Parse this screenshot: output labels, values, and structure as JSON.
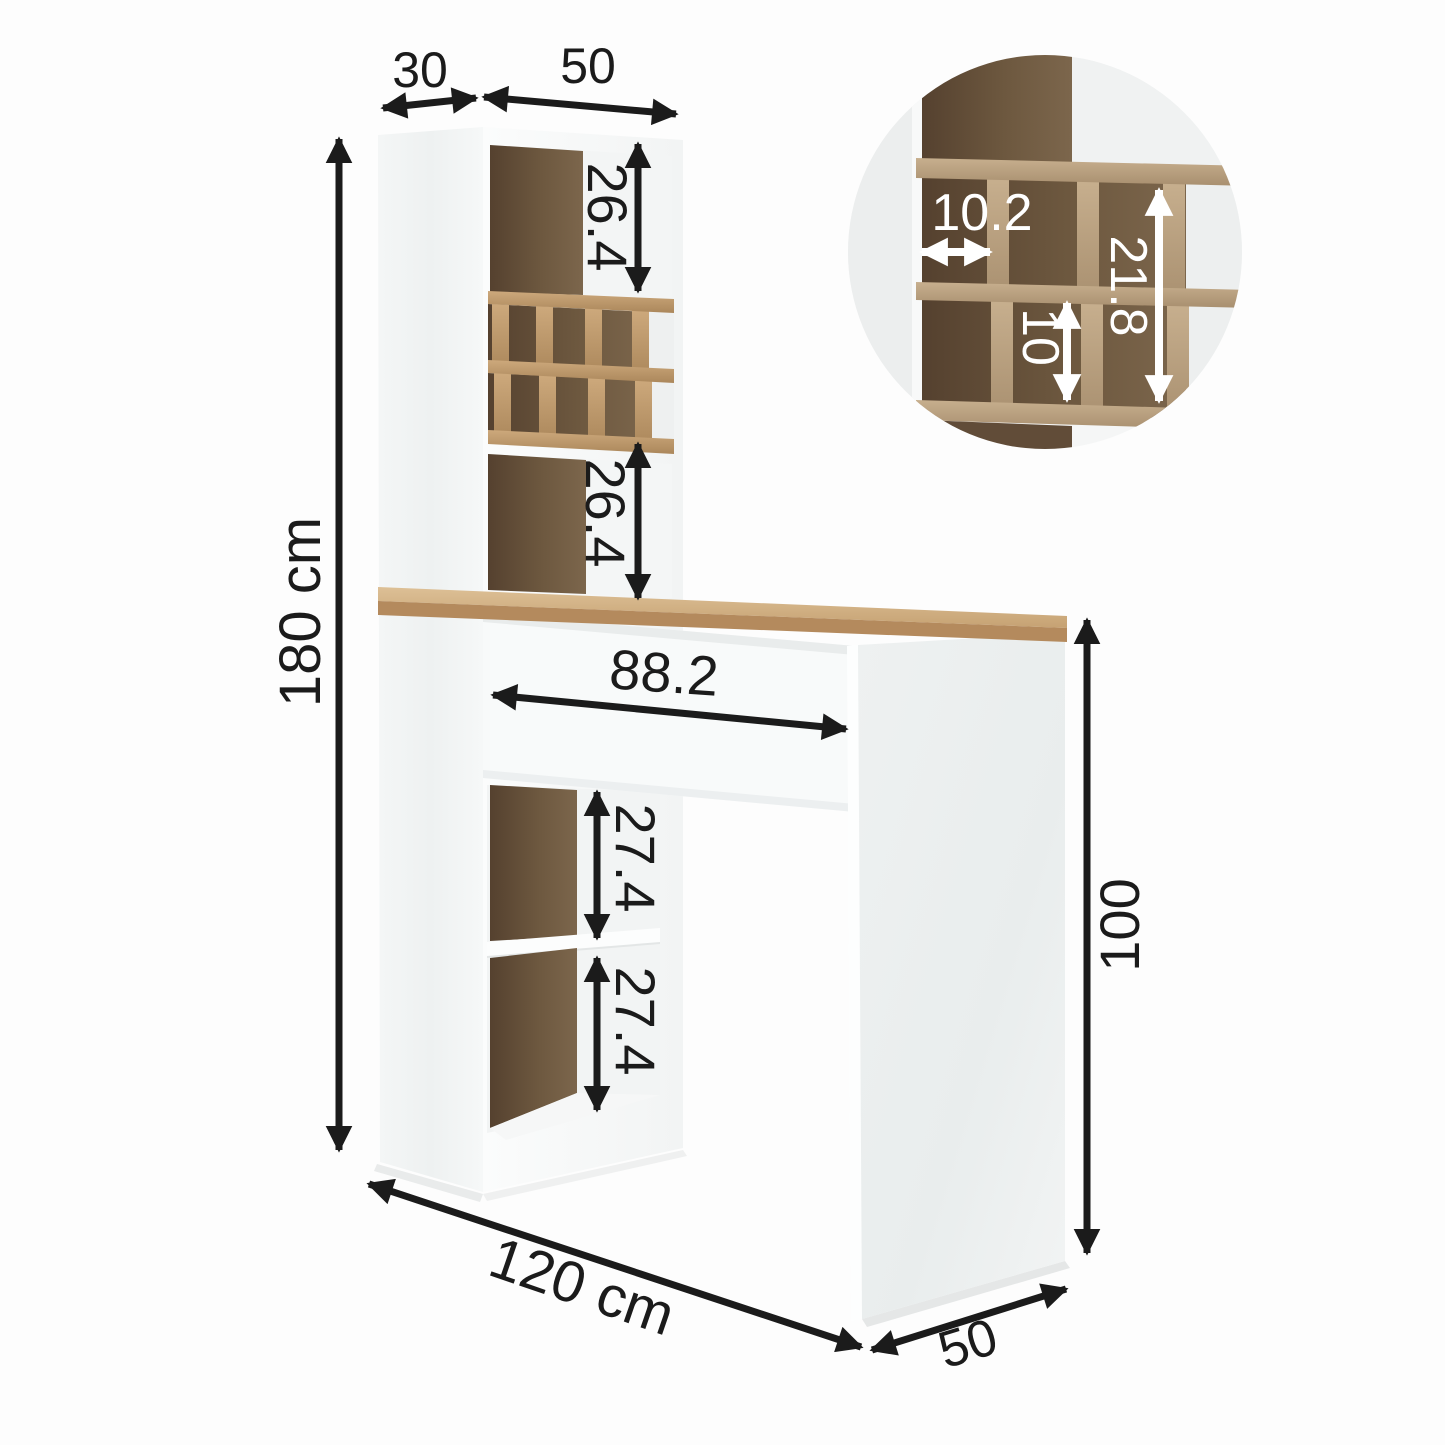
{
  "diagram": {
    "title": "bar-table-with-shelf-dimension-diagram",
    "unit": "cm",
    "colors": {
      "dimension_line": "#1b1b1b",
      "inset_label": "#ffffff",
      "wood_light": "#c29e6f",
      "wood_dark": "#5f4a36",
      "panel_white": "#f7f9f9"
    },
    "dimensions": {
      "cabinet_depth": "30",
      "cabinet_width": "50",
      "total_height": "180 cm",
      "upper_opening_height": "26.4",
      "mid_opening_height": "26.4",
      "worktop_clear_width": "88.2",
      "shelf_opening_top": "27.4",
      "shelf_opening_bottom": "27.4",
      "table_height": "100",
      "total_width": "120 cm",
      "table_depth": "50"
    },
    "inset": {
      "cubby_width": "10.2",
      "cubby_row_height": "10",
      "cubby_column_height": "21.8"
    }
  }
}
